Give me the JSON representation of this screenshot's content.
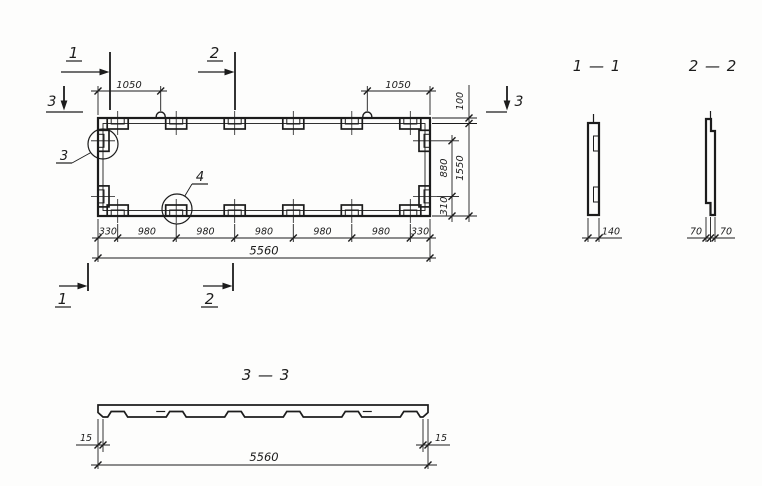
{
  "colors": {
    "ink": "#1c1c1c",
    "paper": "#fdfdfc"
  },
  "plan": {
    "dim_top_left": "1050",
    "dim_top_right": "1050",
    "dim_right_100": "100",
    "dim_right_880": "880",
    "dim_right_310": "310",
    "dim_right_overall": "1550",
    "dim_bottom": [
      "330",
      "980",
      "980",
      "980",
      "980",
      "980",
      "330"
    ],
    "dim_bottom_overall": "5560",
    "marker_1": "1",
    "marker_2": "2",
    "marker_3": "3",
    "detail_3": "3",
    "detail_4": "4"
  },
  "sections": {
    "s11": {
      "title": "1 — 1",
      "dim_width": "140"
    },
    "s22": {
      "title": "2 — 2",
      "dim_left": "70",
      "dim_right": "70"
    },
    "s33": {
      "title": "3 — 3",
      "dim_left": "15",
      "dim_right": "15",
      "dim_overall": "5560"
    }
  }
}
